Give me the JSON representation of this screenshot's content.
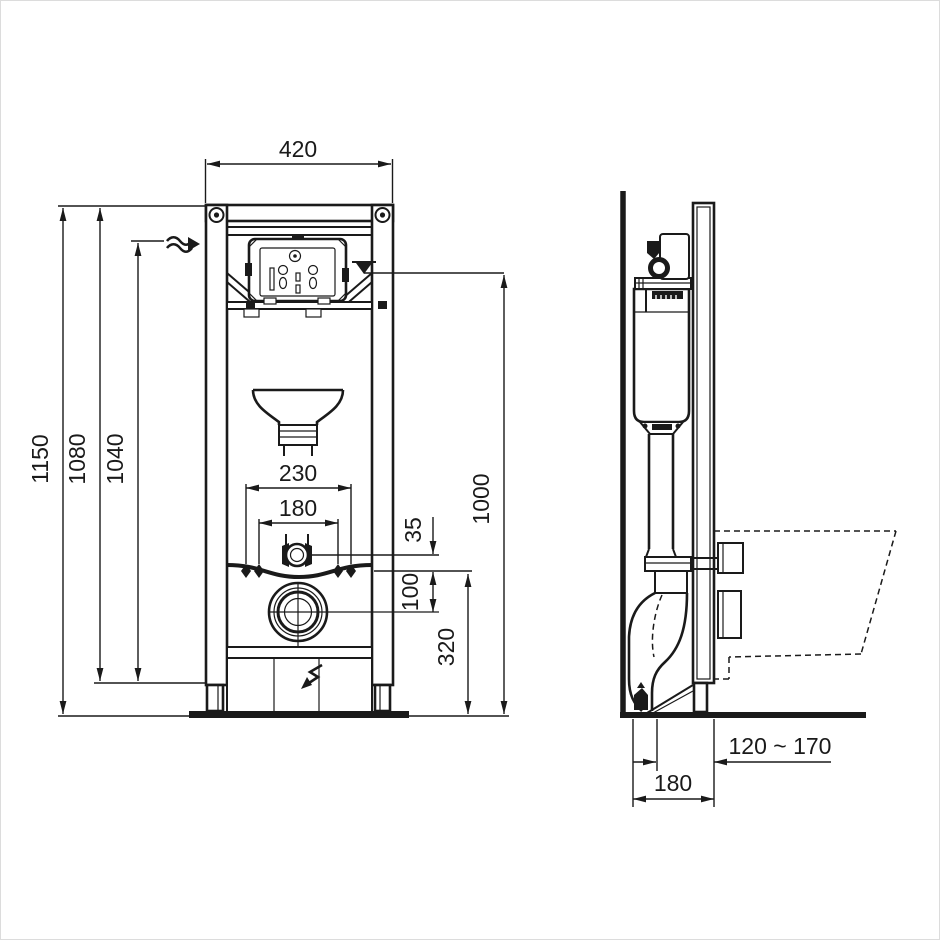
{
  "drawing": {
    "type": "technical-installation-drawing",
    "subject": "wall-hung-wc-frame-with-concealed-cistern",
    "units": "mm",
    "colors": {
      "line": "#1a1a1a",
      "background": "#ffffff",
      "border": "#dcdcdc"
    },
    "front_view": {
      "dims": {
        "width_top": "420",
        "height_overall": "1150",
        "height_frame": "1080",
        "height_water_inlet": "1040",
        "bolt_spacing_outer": "230",
        "bolt_spacing_inner": "180",
        "flushpipe_offset": "35",
        "outlet_offset": "100",
        "height_fixing_bolts": "320",
        "height_water_level": "1000"
      },
      "icons": [
        "water-inlet-arrow-icon",
        "water-level-marker-icon",
        "outlet-direction-arrow-icon"
      ]
    },
    "side_view": {
      "dims": {
        "depth_outlet_range": "120 ~ 170",
        "depth_frame": "180"
      }
    }
  }
}
